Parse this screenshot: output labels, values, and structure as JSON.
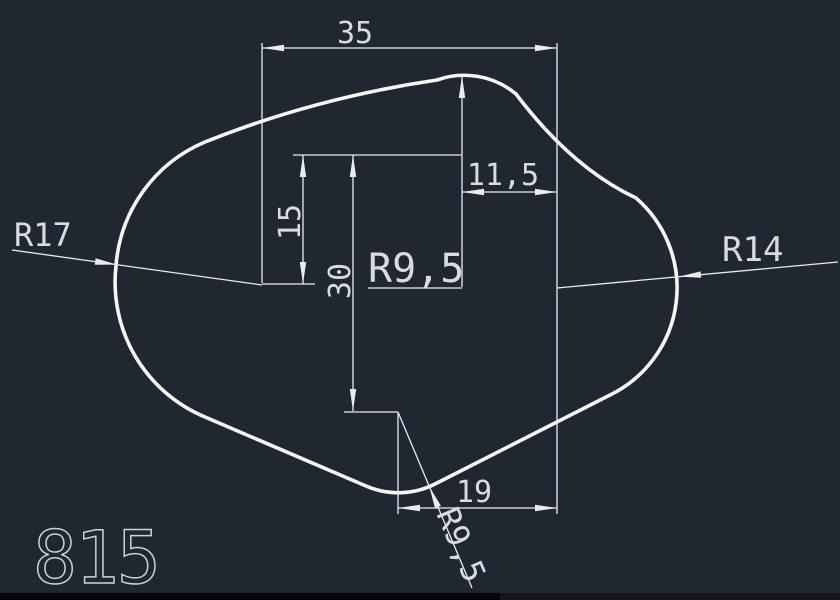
{
  "app": {
    "background_color": "#202731",
    "line_color": "#e9ecef",
    "text_color": "#d8dce1"
  },
  "drawing": {
    "part_label": "815",
    "dims": {
      "top_width": "35",
      "right_offset": "11,5",
      "upper_height": "15",
      "total_height": "30",
      "top_radius": "R9,5",
      "left_radius": "R17",
      "right_radius": "R14",
      "bottom_offset": "19",
      "bottom_radius": "R9,5"
    }
  }
}
